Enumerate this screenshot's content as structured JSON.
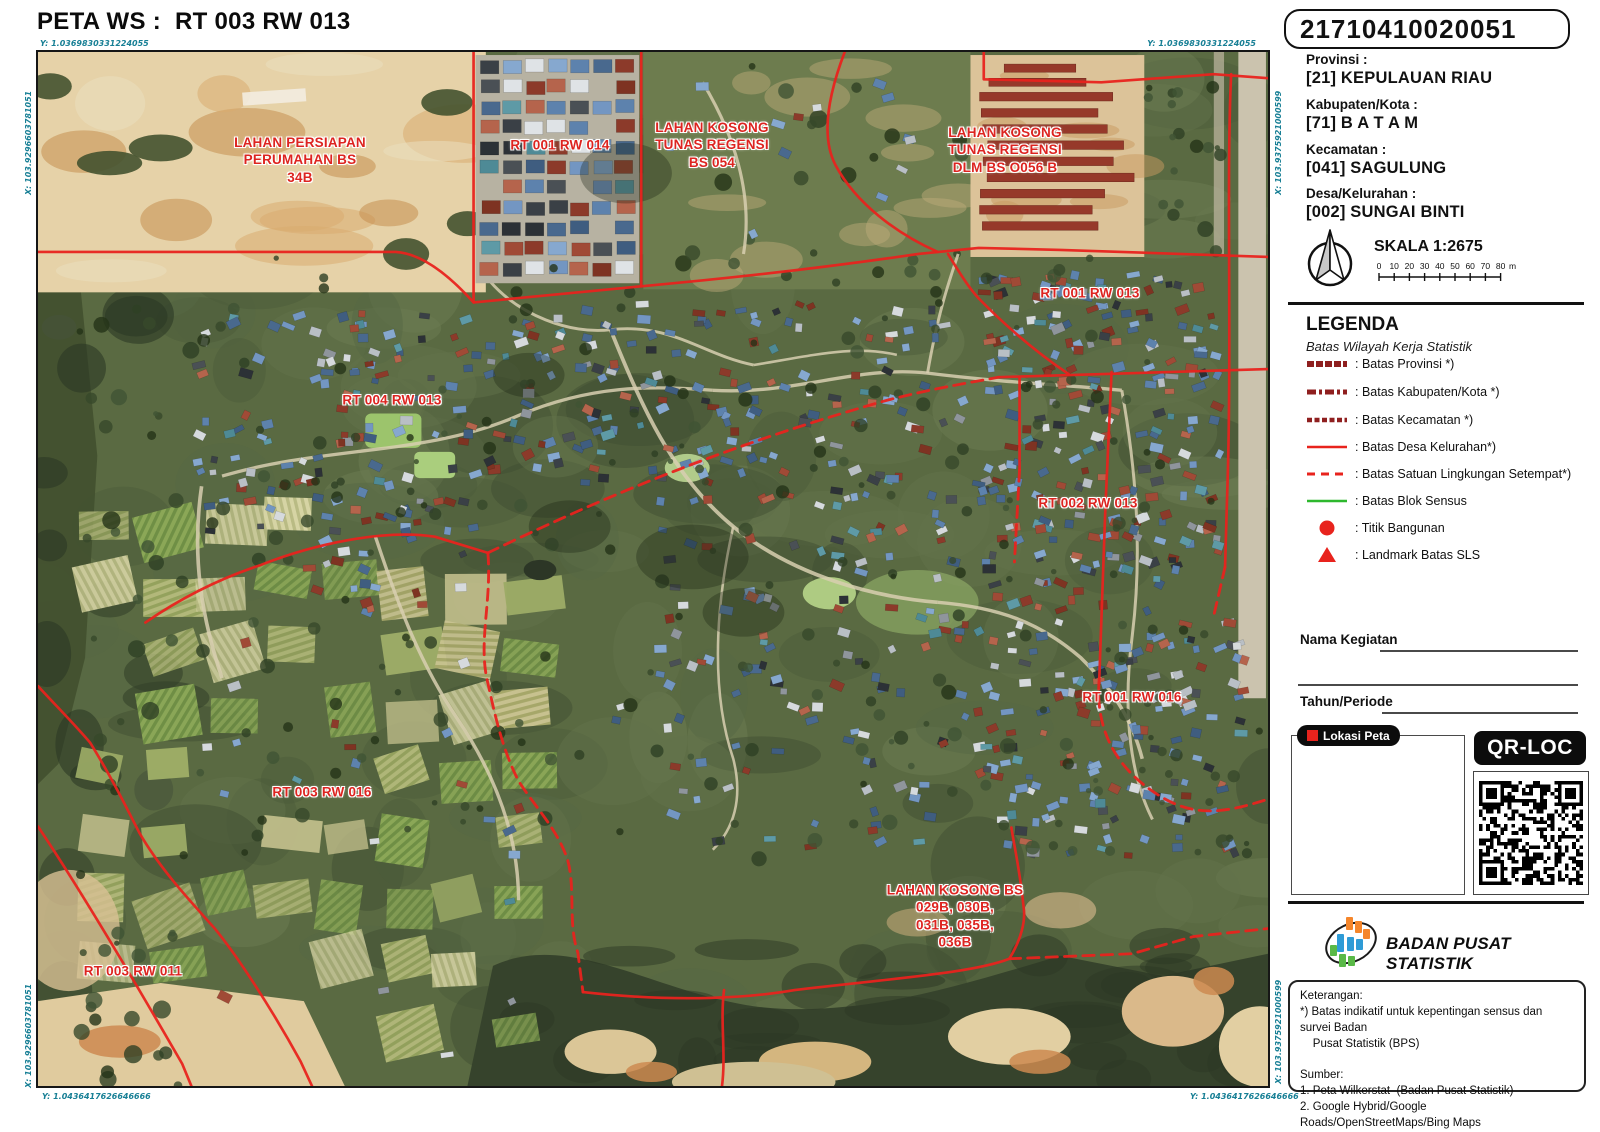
{
  "title": "PETA WS :  RT 003 RW 013",
  "id_code": "21710410020051",
  "region_fields": [
    {
      "label": "Provinsi :",
      "value": "[21] KEPULAUAN RIAU"
    },
    {
      "label": "Kabupaten/Kota :",
      "value": "[71] B A T A M"
    },
    {
      "label": "Kecamatan :",
      "value": "[041] SAGULUNG"
    },
    {
      "label": "Desa/Kelurahan :",
      "value": "[002] SUNGAI BINTI"
    }
  ],
  "scale": {
    "label": "SKALA 1:2675",
    "ticks": [
      "0",
      "10",
      "20",
      "30",
      "40",
      "50",
      "60",
      "70",
      "80"
    ],
    "unit": "m"
  },
  "legend": {
    "heading": "LEGENDA",
    "subheading": "Batas Wilayah Kerja Statistik",
    "items": [
      {
        "swatch": "provinsi",
        "label": ": Batas Provinsi *)"
      },
      {
        "swatch": "kabkota",
        "label": ": Batas Kabupaten/Kota *)"
      },
      {
        "swatch": "kecamatan",
        "label": ": Batas Kecamatan *)"
      },
      {
        "swatch": "desa",
        "label": ": Batas Desa Kelurahan*)"
      },
      {
        "swatch": "sls",
        "label": ": Batas Satuan Lingkungan Setempat*)"
      },
      {
        "swatch": "blok",
        "label": ": Batas Blok Sensus"
      },
      {
        "swatch": "titik",
        "label": ": Titik Bangunan"
      },
      {
        "swatch": "landmark",
        "label": ": Landmark Batas SLS"
      }
    ]
  },
  "form": {
    "nama_kegiatan": "Nama Kegiatan",
    "tahun_periode": "Tahun/Periode"
  },
  "lokasi_peta_label": "Lokasi Peta",
  "qr_label": "QR-LOC",
  "agency": "BADAN PUSAT STATISTIK",
  "keterangan_lines": [
    "Keterangan:",
    "*) Batas indikatif untuk kepentingan sensus dan survei Badan",
    "    Pusat Statistik (BPS)",
    "",
    "Sumber:",
    "1. Peta Wilkerstat  (Badan Pusat Statistik)",
    "2. Google Hybrid/Google Roads/OpenStreetMaps/Bing Maps"
  ],
  "map": {
    "corner_coords": {
      "top_left_y": "Y: 1.0369830331224055",
      "top_right_y": "Y: 1.0369830331224055",
      "bottom_left_y": "Y: 1.0436417626646666",
      "bottom_right_y": "Y: 1.0436417626646666",
      "left_x": "X: 103.9296603781051",
      "right_x": "X: 103.9375921000599"
    },
    "labels": [
      {
        "text": "LAHAN PERSIAPAN\nPERUMAHAN BS\n34B",
        "x": 300,
        "y": 160
      },
      {
        "text": "RT 001 RW 014",
        "x": 560,
        "y": 145
      },
      {
        "text": "LAHAN KOSONG\nTUNAS REGENSI\nBS 054",
        "x": 712,
        "y": 145
      },
      {
        "text": "LAHAN KOSONG\nTUNAS REGENSI\nDLM BS O056 B",
        "x": 1005,
        "y": 150
      },
      {
        "text": "RT 001 RW 013",
        "x": 1090,
        "y": 293
      },
      {
        "text": "RT 004 RW 013",
        "x": 392,
        "y": 400
      },
      {
        "text": "RT 002 RW 013",
        "x": 1088,
        "y": 503
      },
      {
        "text": "RT 001 RW 016",
        "x": 1132,
        "y": 697
      },
      {
        "text": "RT 003 RW 016",
        "x": 322,
        "y": 792
      },
      {
        "text": "RT 003 RW 011",
        "x": 133,
        "y": 971
      },
      {
        "text": "LAHAN KOSONG BS\n029B, 030B,\n031B, 035B,\n036B",
        "x": 955,
        "y": 916
      }
    ]
  },
  "colors": {
    "boundary_red": "#e8231d",
    "admin_dark_red": "#8f1f1f",
    "blok_green": "#2eb82e",
    "coord_teal": "#177f95",
    "label_red": "#dd2420"
  }
}
